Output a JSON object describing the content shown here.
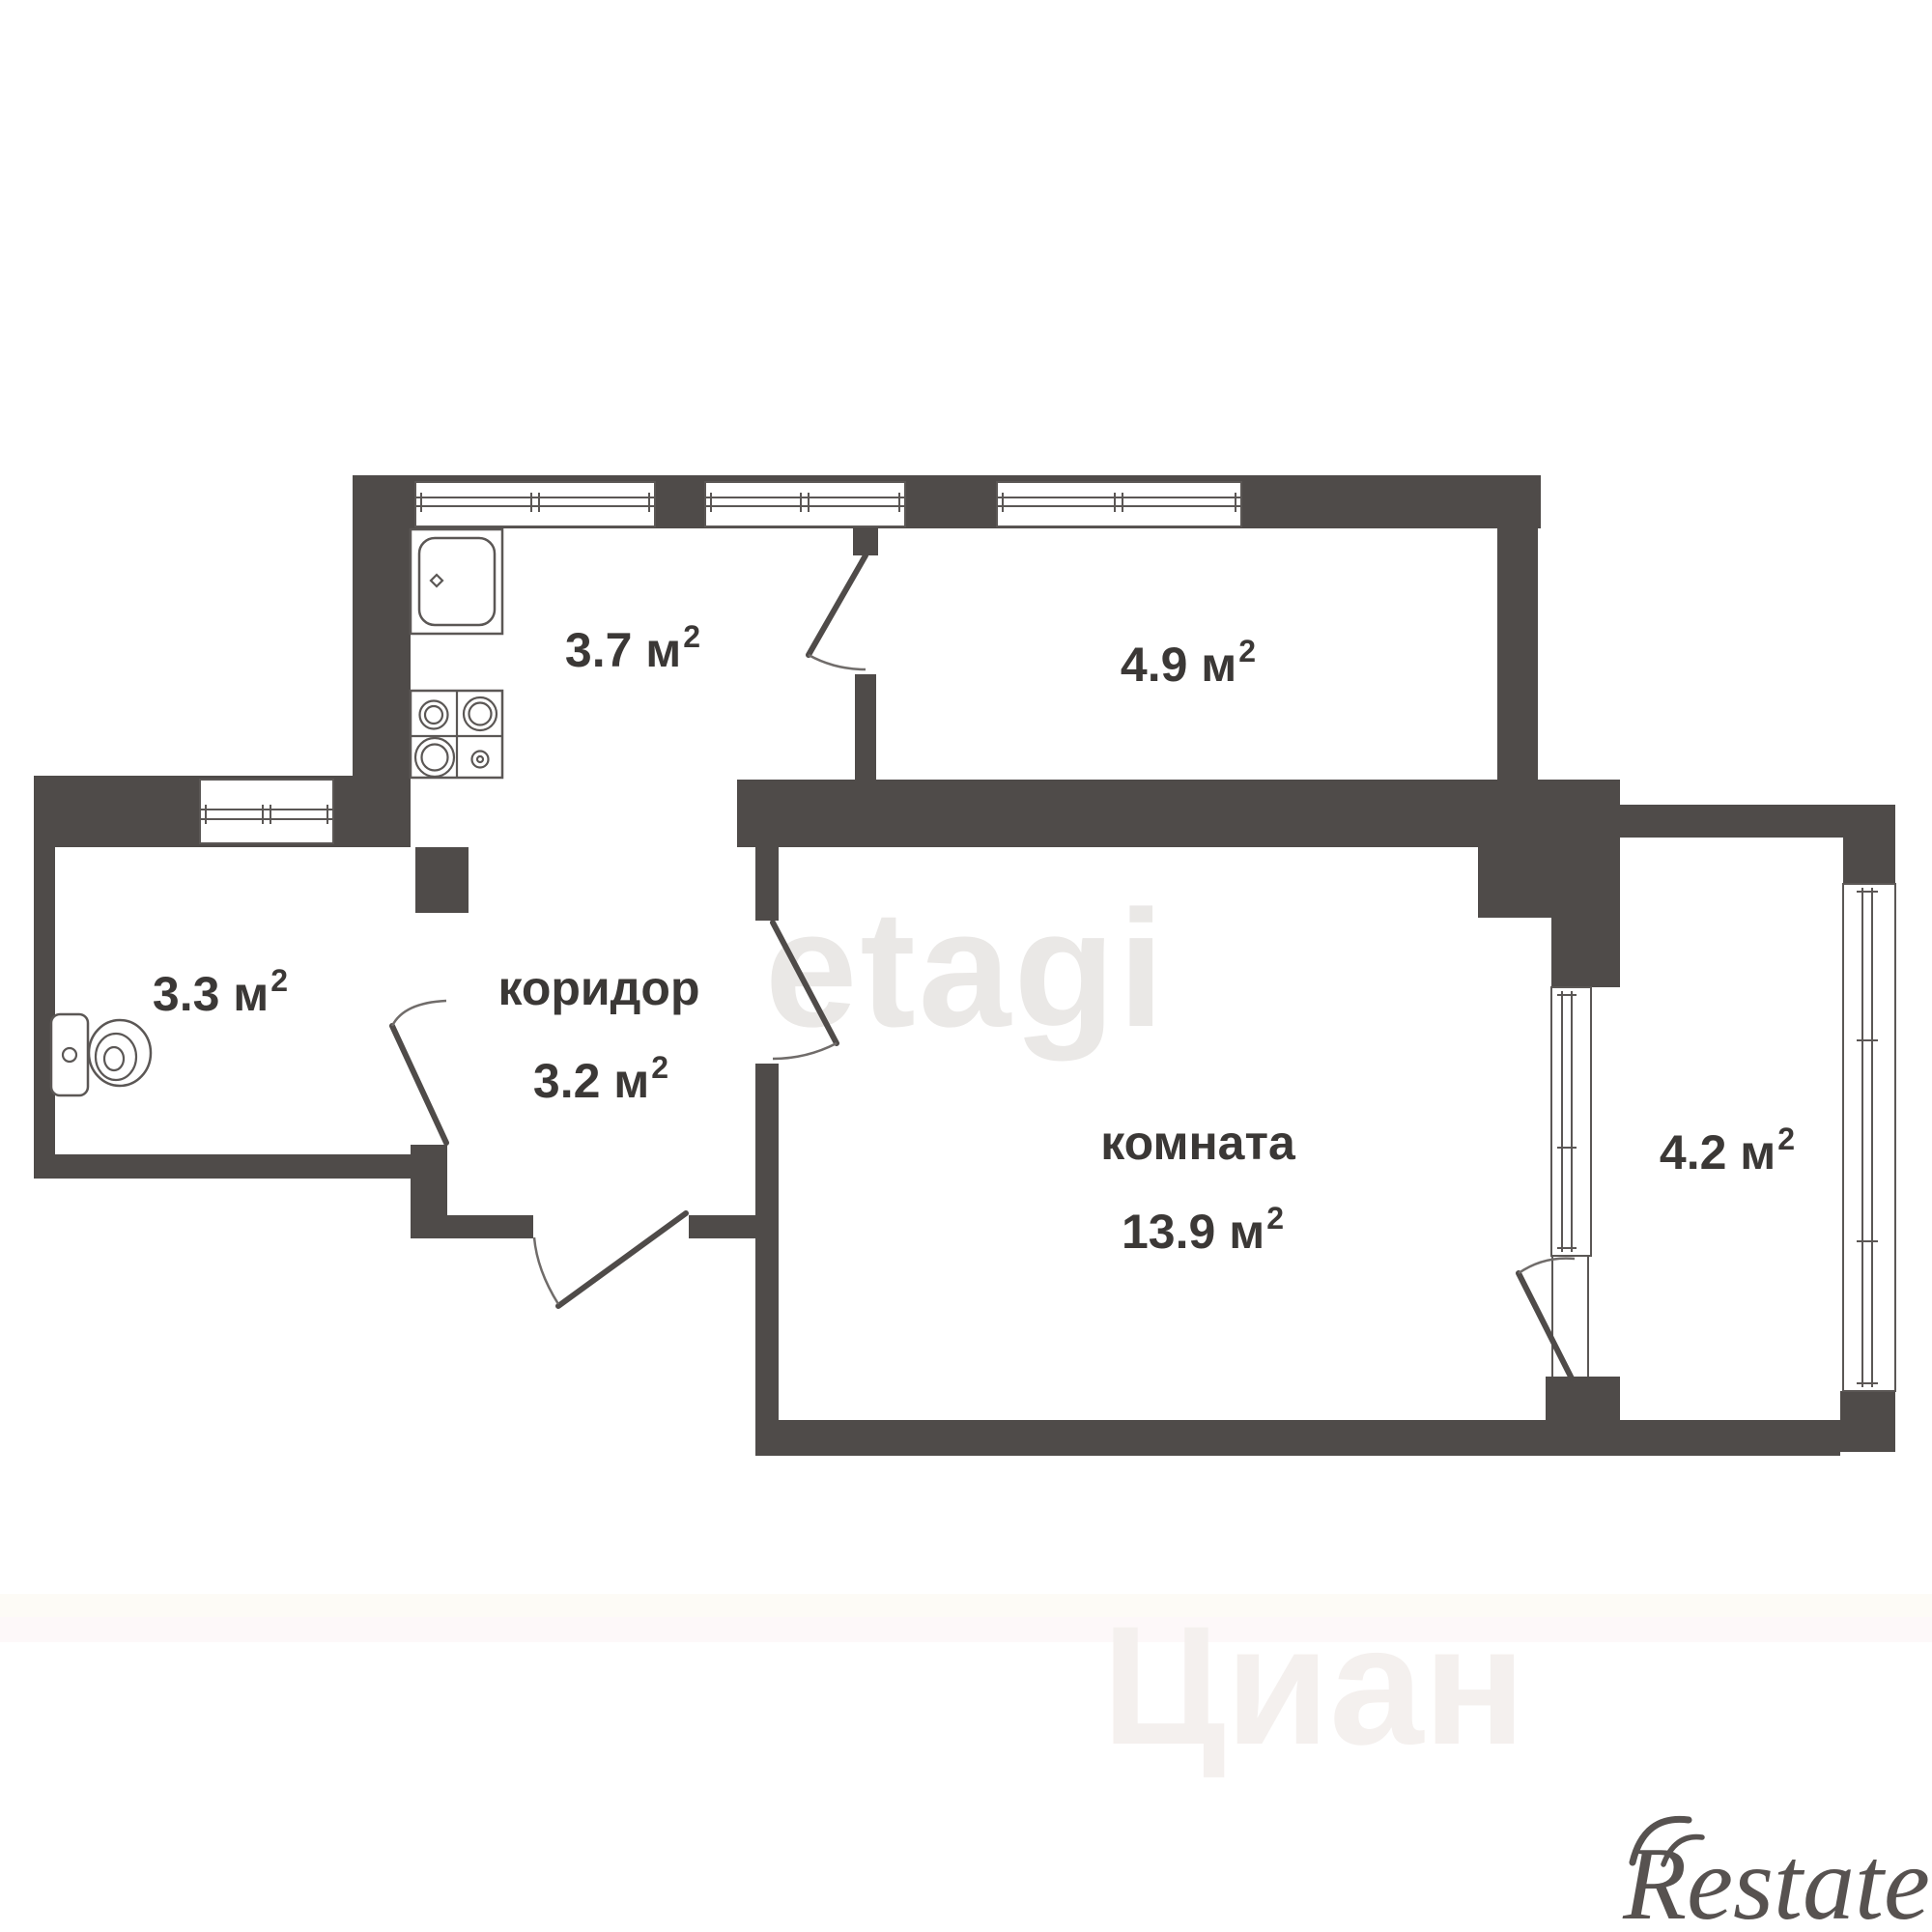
{
  "plan": {
    "rooms": {
      "kitchen": {
        "area": "3.7 м",
        "sup": "2"
      },
      "room49": {
        "area": "4.9 м",
        "sup": "2"
      },
      "bathroom": {
        "area": "3.3 м",
        "sup": "2"
      },
      "corridor": {
        "name": "коридор",
        "area": "3.2 м",
        "sup": "2"
      },
      "main_room": {
        "name": "комната",
        "area": "13.9 м",
        "sup": "2"
      },
      "balcony": {
        "area": "4.2 м",
        "sup": "2"
      }
    },
    "fixtures": [
      {
        "icon": "sink-icon"
      },
      {
        "icon": "stove-icon"
      },
      {
        "icon": "toilet-icon"
      }
    ]
  },
  "watermarks": {
    "center": "etagi",
    "bottom": "Циан",
    "logo": "Restate"
  },
  "colors": {
    "wall": "#4f4b49",
    "line": "#5b5755",
    "text": "#3b3836",
    "watermark_center": "#eae8e6",
    "watermark_bottom": "#f4f0ee",
    "logo": "#575250"
  }
}
